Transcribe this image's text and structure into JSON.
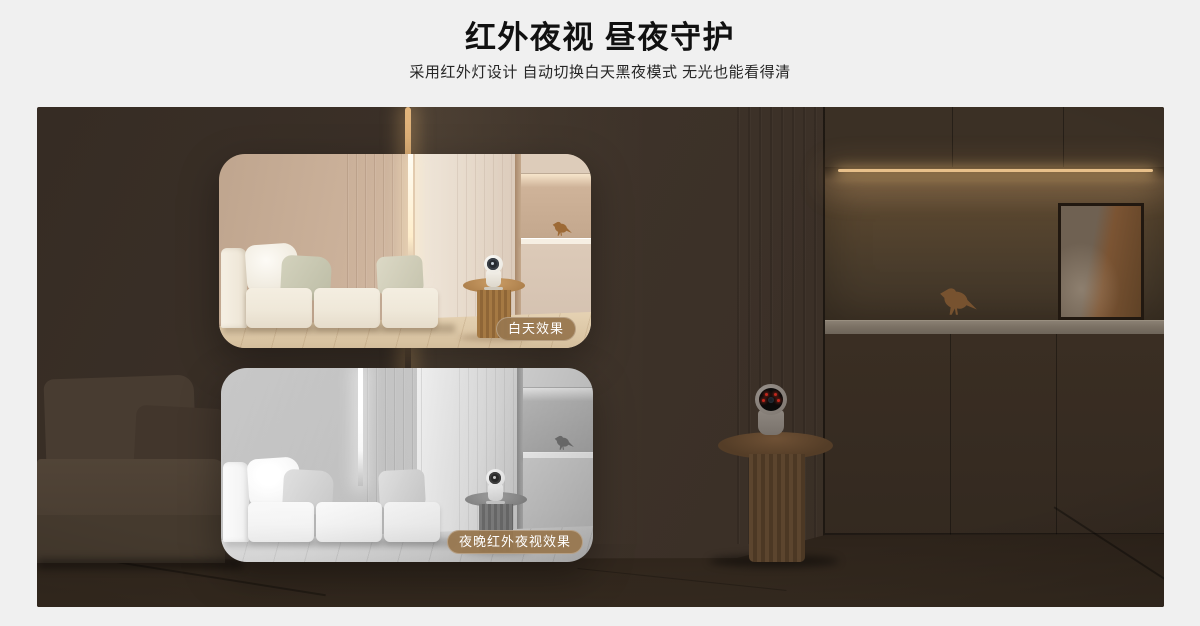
{
  "header": {
    "title": "红外夜视 昼夜守护",
    "subtitle": "采用红外灯设计 自动切换白天黑夜模式 无光也能看得清"
  },
  "hero": {
    "insets": [
      {
        "id": "day",
        "badge": "白天效果"
      },
      {
        "id": "night",
        "badge": "夜晚红外夜视效果"
      }
    ],
    "colors": {
      "page_background": "#f0f0f0",
      "room_shadow": "#3a2f26",
      "badge_background": "#98774f",
      "badge_text": "#ffffff",
      "led_warm_glow": "#e8c08a",
      "ir_led_red": "#c2271c"
    }
  }
}
